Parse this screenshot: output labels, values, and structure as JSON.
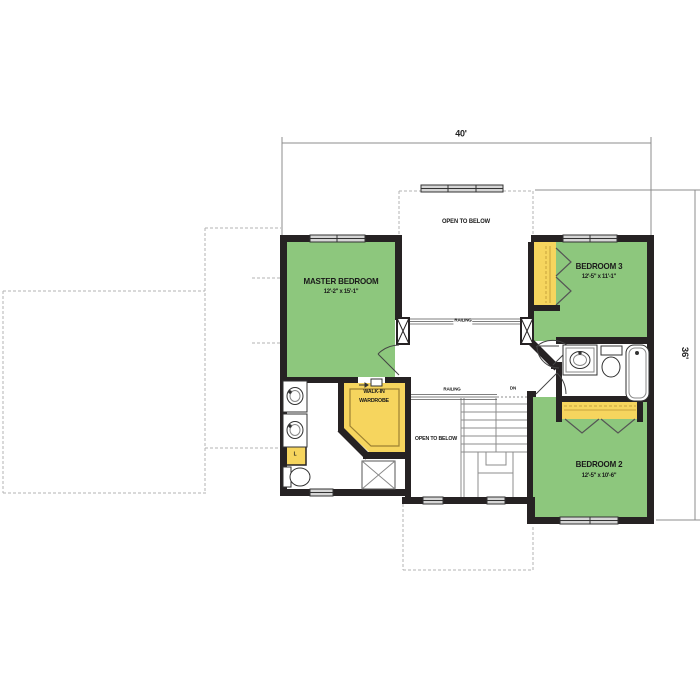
{
  "plan": {
    "dimensions": {
      "width": "40'",
      "depth": "36'"
    },
    "rooms": [
      {
        "id": "master_bedroom",
        "name": "MASTER BEDROOM",
        "size": "12'-2\" x 15'-1\"",
        "fill": "green"
      },
      {
        "id": "bedroom_3",
        "name": "BEDROOM 3",
        "size": "12'-5\" x 11'-1\"",
        "fill": "green"
      },
      {
        "id": "bedroom_2",
        "name": "BEDROOM 2",
        "size": "12'-5\" x 10'-6\"",
        "fill": "green"
      },
      {
        "id": "walk_in_wardrobe",
        "name_line1": "WALK-IN",
        "name_line2": "WARDROBE",
        "fill": "yellow"
      }
    ],
    "labels": {
      "open_to_below_upper": "OPEN TO BELOW",
      "open_to_below_lower": "OPEN TO BELOW",
      "railing_upper": "RAILING",
      "railing_lower": "RAILING",
      "down": "DN",
      "linen": "L"
    },
    "fixtures": [
      "double-vanity-sink",
      "toilet",
      "shower",
      "linen-closet",
      "walk-in-wardrobe",
      "vanity-sink",
      "bathtub",
      "stairs-down",
      "bifold-closet-doors",
      "window",
      "door",
      "railing",
      "newel-post"
    ],
    "colors": {
      "bedroom_fill": "#8dc77d",
      "closet_fill": "#f6d55e",
      "wall": "#262223",
      "window_fill": "#d6d6d6",
      "line_thin": "#999999",
      "text": "#1a1a1a"
    }
  }
}
